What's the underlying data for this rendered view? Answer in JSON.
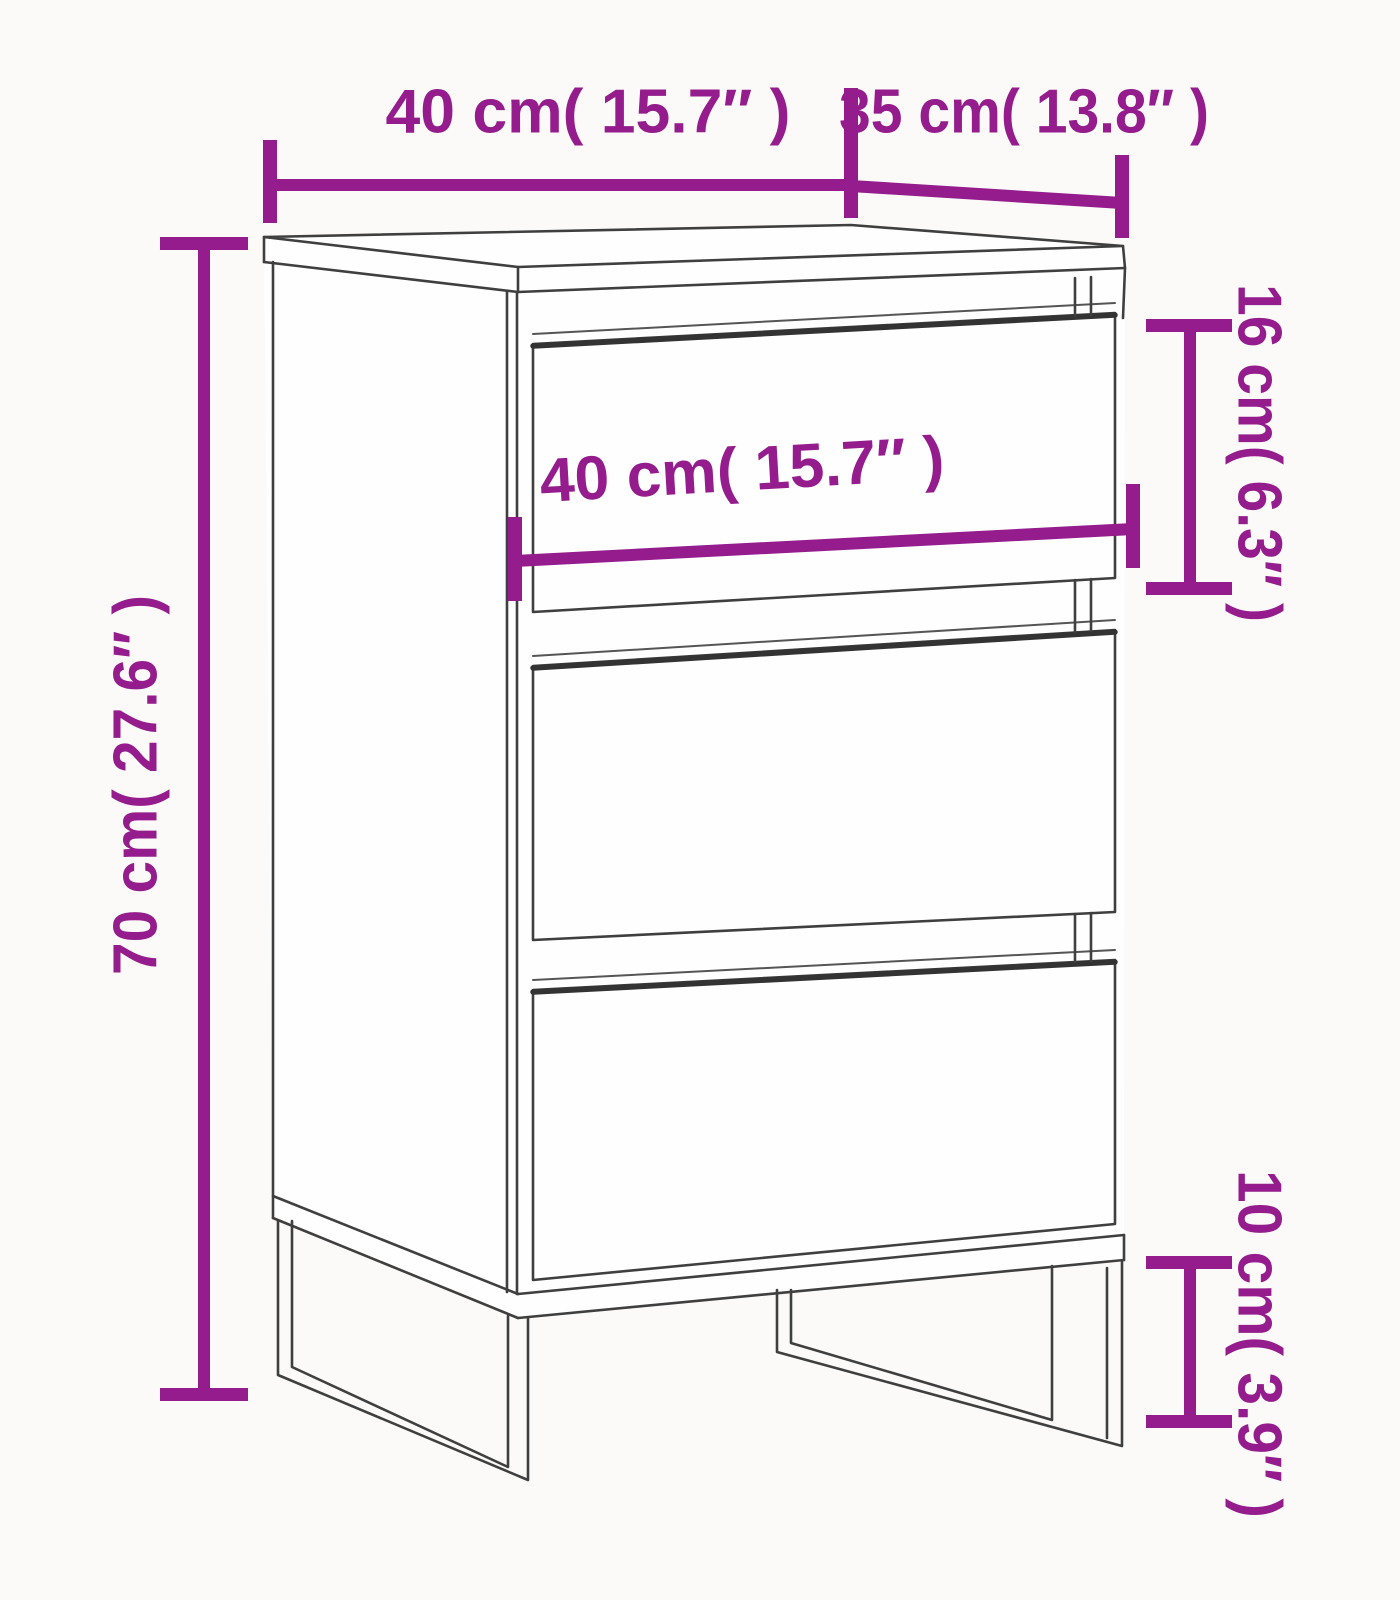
{
  "diagram": {
    "kind": "furniture-dimension-diagram",
    "subject": "sideboard with 3 drawers and 4 metal sled legs",
    "drawer_count": 3,
    "colors": {
      "accent": "#941c8c",
      "line": "#3f3f3f",
      "background": "#fbfaf8",
      "face": "#fefefe"
    },
    "dimensions": {
      "top_width": {
        "label": "40 cm( 15.7″ )",
        "cm": 40,
        "inches": 15.7
      },
      "top_depth": {
        "label": "35 cm( 13.8″ )",
        "cm": 35,
        "inches": 13.8
      },
      "height": {
        "label": "70 cm( 27.6″ )",
        "cm": 70,
        "inches": 27.6
      },
      "drawer_width": {
        "label": "40 cm( 15.7″ )",
        "cm": 40,
        "inches": 15.7
      },
      "drawer_height": {
        "label": "16 cm( 6.3″ )",
        "cm": 16,
        "inches": 6.3
      },
      "leg_height": {
        "label": "10 cm( 3.9″ )",
        "cm": 10,
        "inches": 3.9
      }
    }
  }
}
